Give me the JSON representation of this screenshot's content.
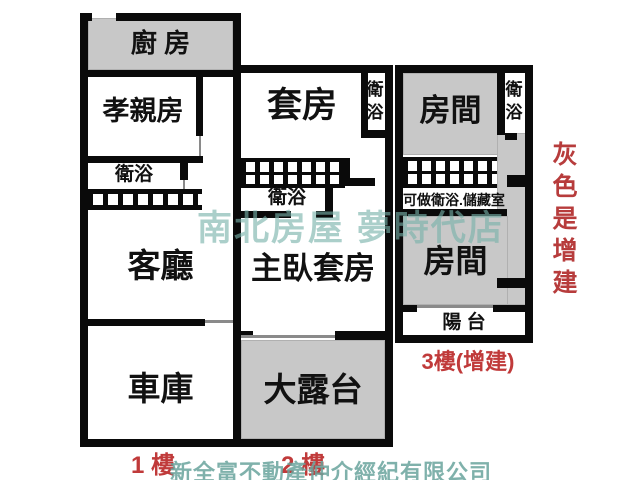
{
  "plan": {
    "floor1": {
      "floor_label": "1 樓",
      "kitchen": "廚 房",
      "parents_room": "孝親房",
      "bathroom": "衛浴",
      "living_room": "客廳",
      "garage": "車庫"
    },
    "floor2": {
      "floor_label": "2 樓",
      "suite": "套房",
      "bathroom_top": "衛浴",
      "bathroom_mid": "衛浴",
      "master_suite": "主臥套房",
      "terrace": "大露台"
    },
    "floor3": {
      "floor_label": "3樓(增建)",
      "room_top": "房間",
      "bathroom": "衛浴",
      "storage_note": "可做衛浴.儲藏室",
      "room_bottom": "房間",
      "balcony": "陽 台"
    }
  },
  "annotations": {
    "gray_note": "灰色是增建"
  },
  "watermarks": {
    "brand": "南北房屋 夢時代店",
    "company": "新全富不動產仲介經紀有限公司"
  },
  "colors": {
    "addition_gray": "#c8c8c8",
    "wall_black": "#0a0a0a",
    "note_red": "#c03a3a",
    "watermark_teal": "#78b2aa"
  }
}
